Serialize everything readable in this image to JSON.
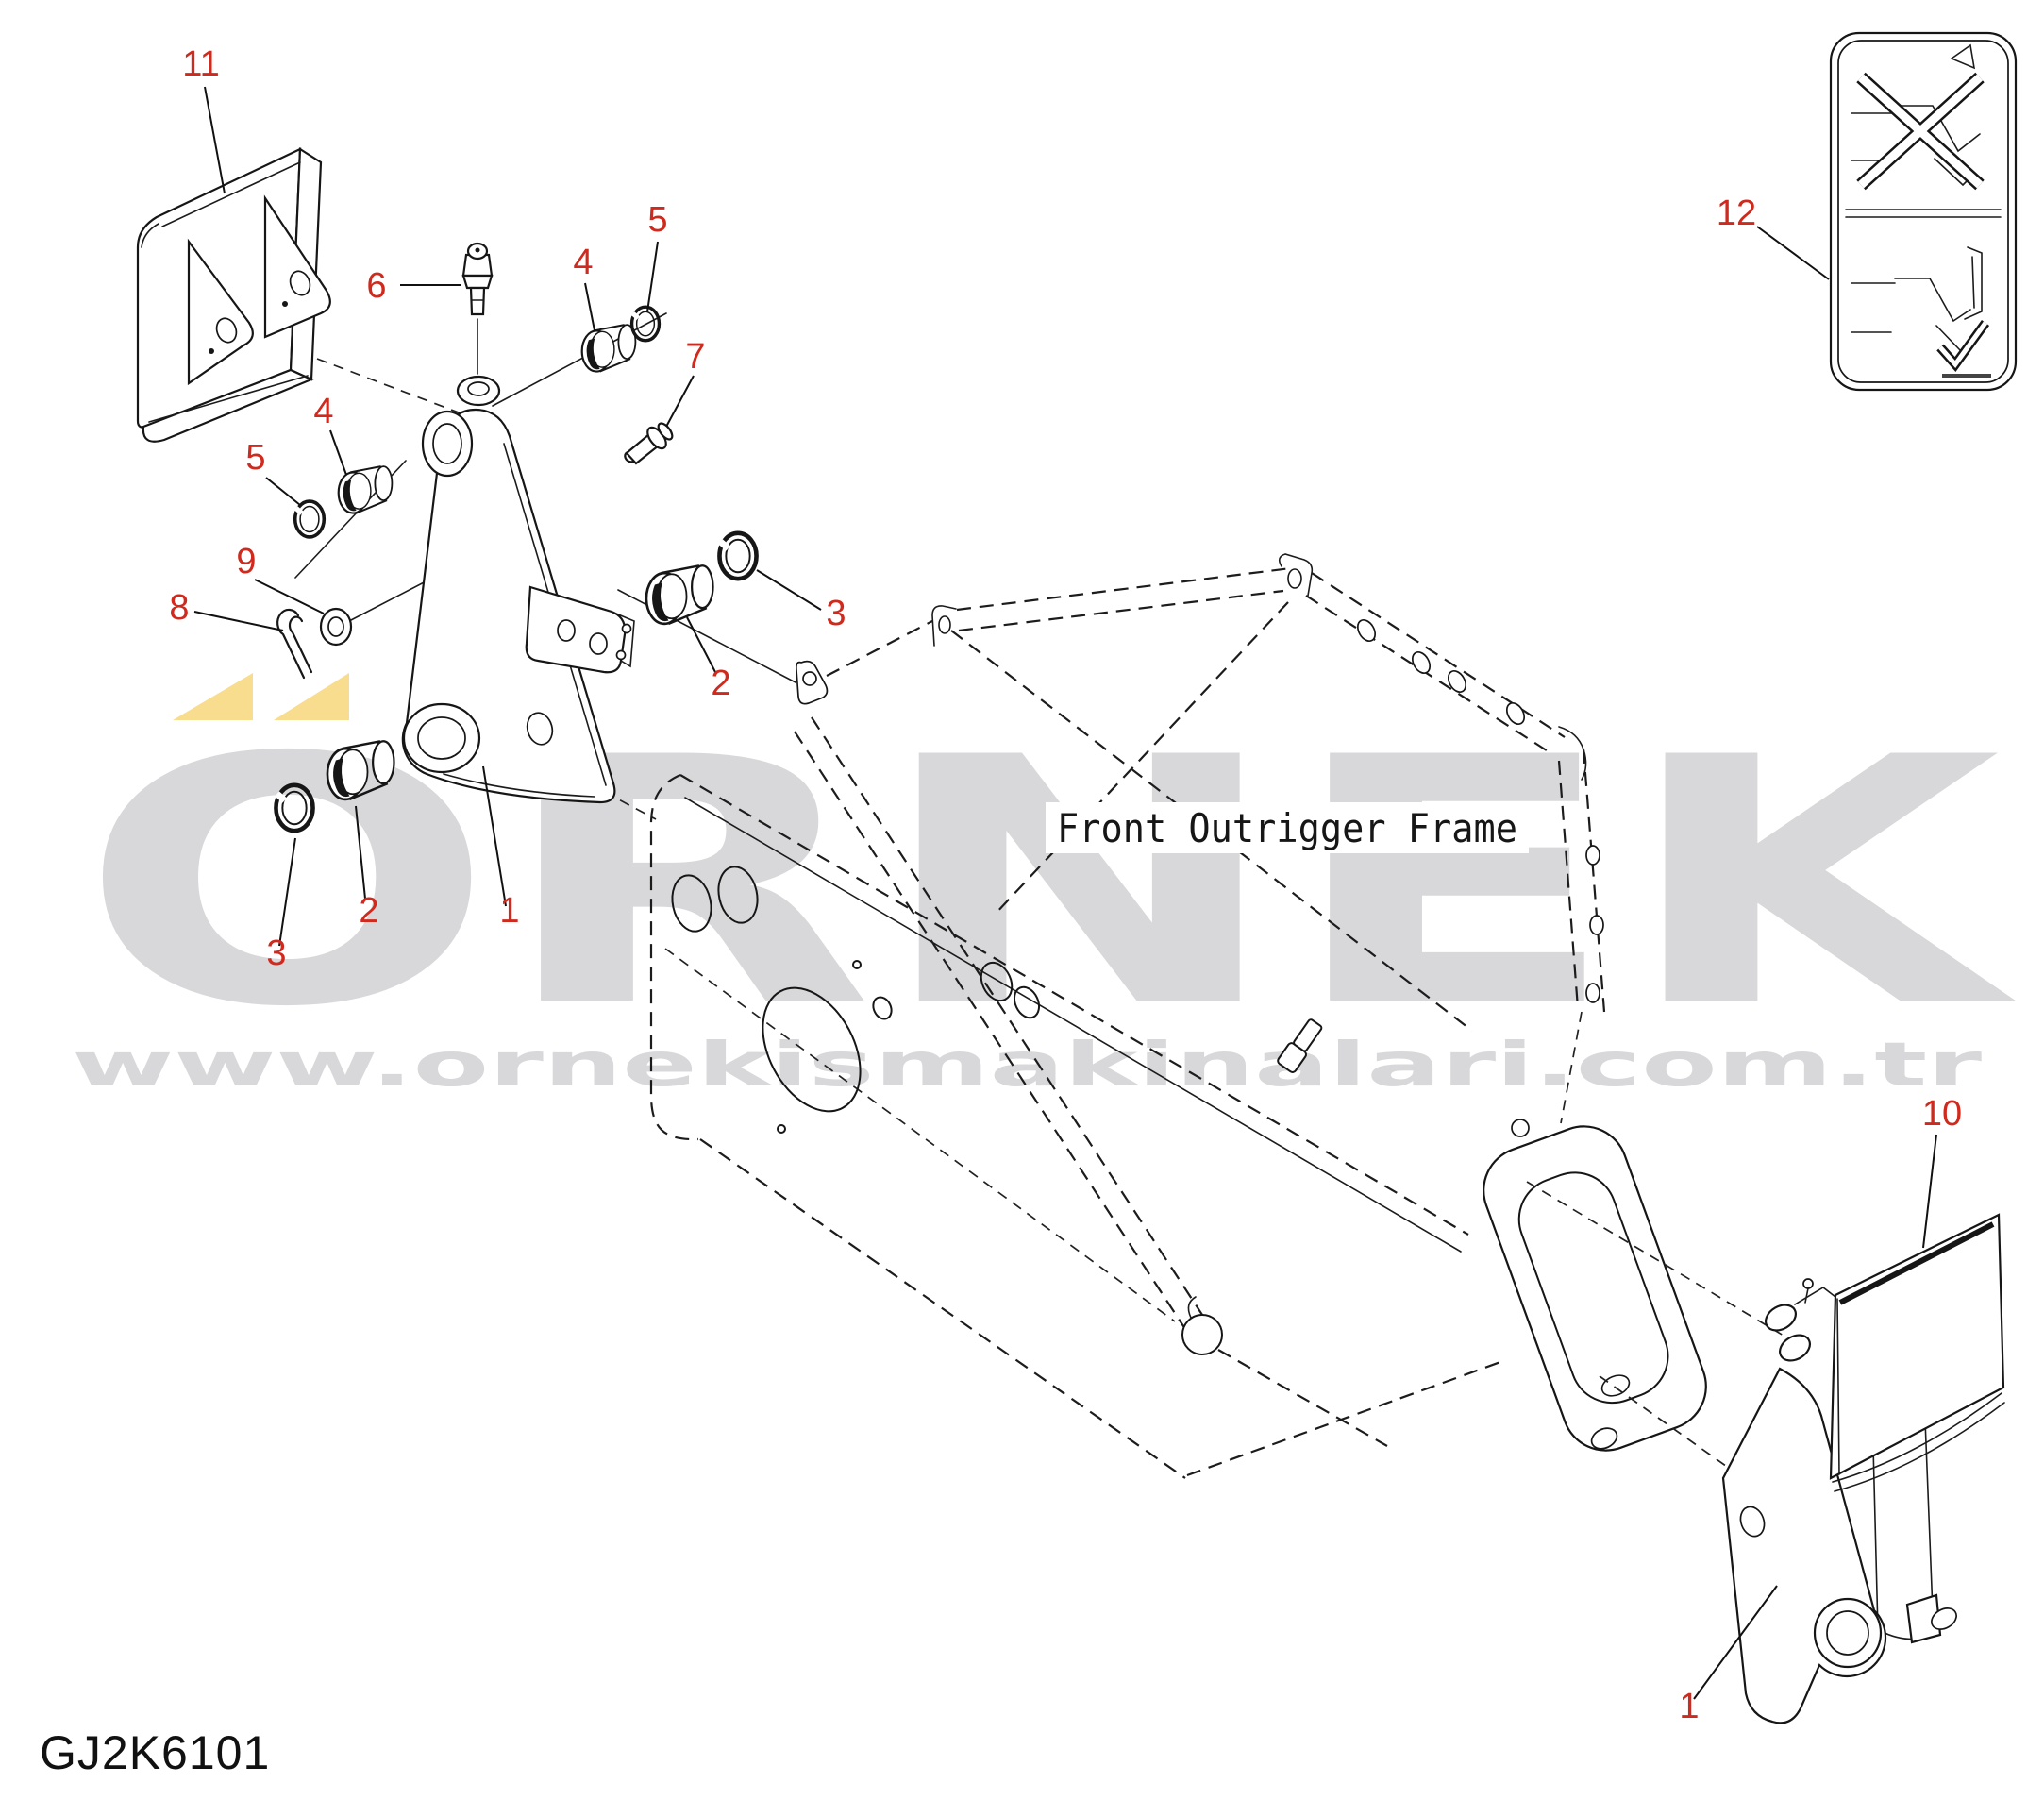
{
  "drawing_code": "GJ2K6101",
  "frame_annotation": "Front Outrigger Frame",
  "watermark": {
    "brand_letters": "ORNEK",
    "brand_display": "ÖRNEK",
    "url": "www.ornekismakinalari.com.tr",
    "letter_color": "#d8d8da",
    "accent_color": "#f8dd8e"
  },
  "colors": {
    "callout_red": "#cf2a1d",
    "line_art": "#161616",
    "background": "#ffffff"
  },
  "callouts": [
    {
      "label": "11"
    },
    {
      "label": "6"
    },
    {
      "label": "4"
    },
    {
      "label": "5"
    },
    {
      "label": "7"
    },
    {
      "label": "4"
    },
    {
      "label": "5"
    },
    {
      "label": "9"
    },
    {
      "label": "8"
    },
    {
      "label": "3"
    },
    {
      "label": "2"
    },
    {
      "label": "2"
    },
    {
      "label": "3"
    },
    {
      "label": "1"
    },
    {
      "label": "12"
    },
    {
      "label": "10"
    },
    {
      "label": "1"
    }
  ]
}
